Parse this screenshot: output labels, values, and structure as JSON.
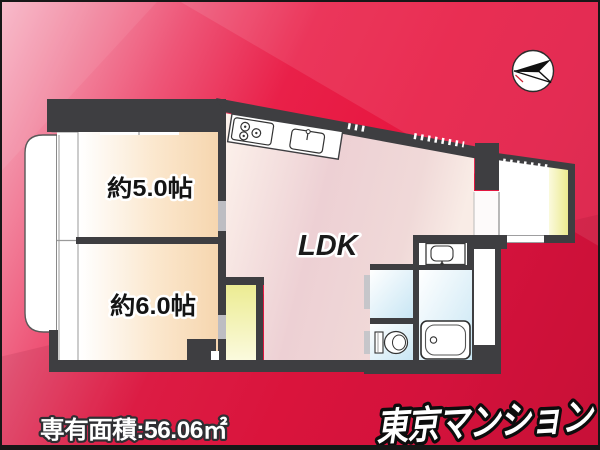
{
  "image_type": "real-estate-floor-plan",
  "background": {
    "pink": "#f5a4b8",
    "red": "#e81741",
    "deep_red": "#d2123a"
  },
  "compass": {
    "icon": "north-arrow-icon"
  },
  "floor_plan": {
    "wall_color": "#3e3e41",
    "fills": {
      "bedroom": "#f8dcba",
      "ldk": "#ecccd1",
      "closet": "#f0efa2",
      "wet_area": "#cfe9f5",
      "balcony": "#ffffff"
    },
    "rooms": {
      "room5": {
        "label": "約5.0帖"
      },
      "room6": {
        "label": "約6.0帖"
      },
      "ldk": {
        "label": "LDK"
      }
    },
    "fixtures": {
      "stove": "gas-stove-3-burner",
      "kitchen_sink": "kitchen-sink",
      "washbasin": "washbasin",
      "toilet": "toilet",
      "bathtub": "bathtub"
    }
  },
  "footer": {
    "area_label": "専有面積:56.06㎡"
  },
  "brand": {
    "logo": "東京マンション"
  }
}
